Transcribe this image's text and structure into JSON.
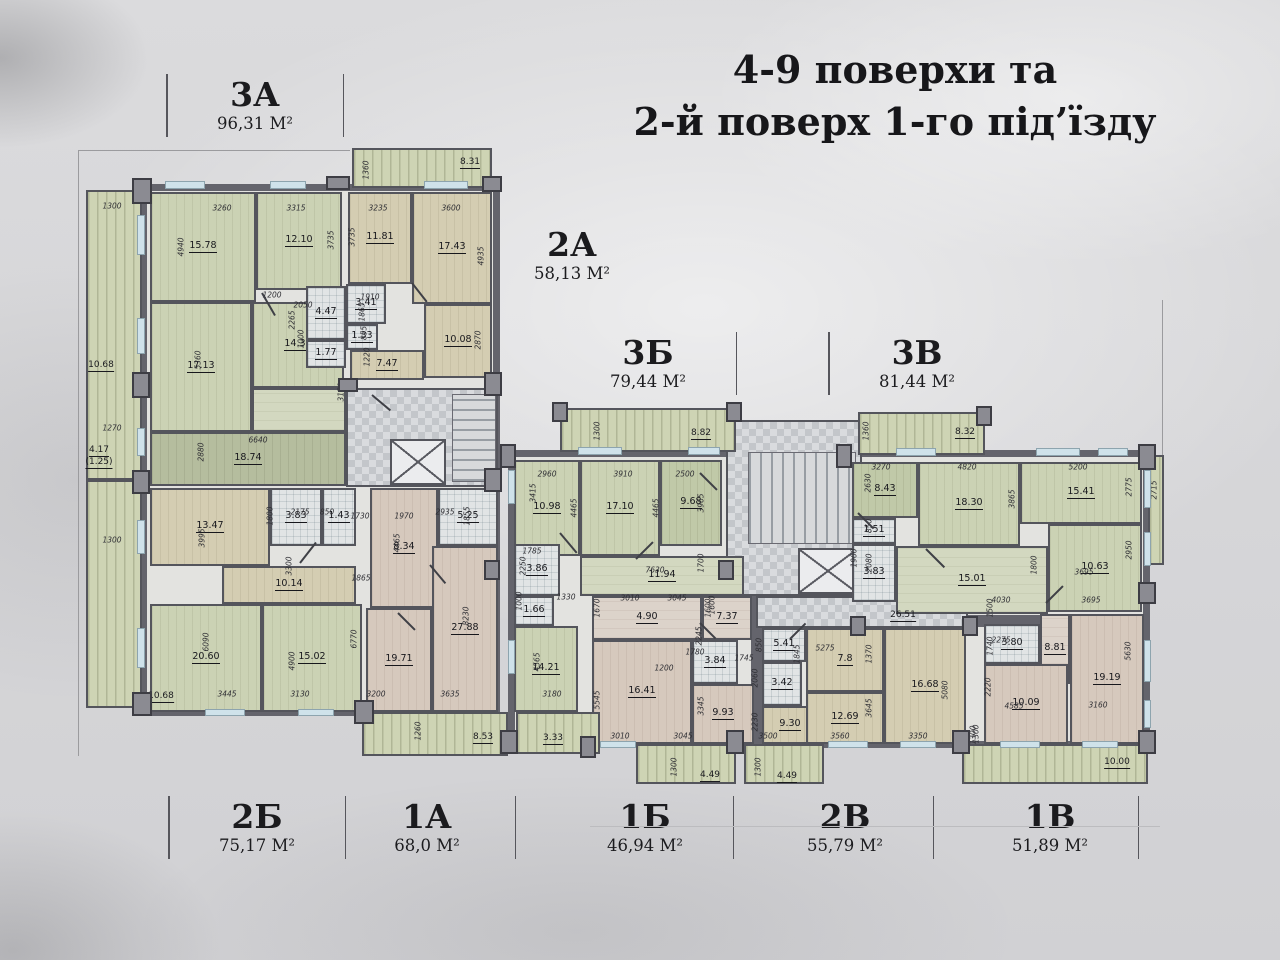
{
  "title": {
    "line1": "4-9 поверхи та",
    "line2": "2-й поверх 1-го під’їзду"
  },
  "apartments": [
    {
      "name": "3А",
      "area": "96,31 М²"
    },
    {
      "name": "2А",
      "area": "58,13 М²"
    },
    {
      "name": "3Б",
      "area": "79,44 М²"
    },
    {
      "name": "3В",
      "area": "81,44 М²"
    },
    {
      "name": "2Б",
      "area": "75,17 М²"
    },
    {
      "name": "1А",
      "area": "68,0 М²"
    },
    {
      "name": "1Б",
      "area": "46,94 М²"
    },
    {
      "name": "2В",
      "area": "55,79 М²"
    },
    {
      "name": "1В",
      "area": "51,89 М²"
    }
  ],
  "rooms": [
    {
      "a": "15.78",
      "x": 150,
      "y": 192,
      "w": 106,
      "h": 110,
      "f": "g"
    },
    {
      "a": "12.10",
      "x": 256,
      "y": 192,
      "w": 86,
      "h": 98,
      "f": "g"
    },
    {
      "a": "17.13",
      "x": 150,
      "y": 302,
      "w": 102,
      "h": 130,
      "f": "g"
    },
    {
      "a": "14.39",
      "x": 252,
      "y": 302,
      "w": 92,
      "h": 86,
      "f": "g"
    },
    {
      "a": "4.47",
      "x": 306,
      "y": 286,
      "w": 40,
      "h": 54,
      "f": "ba"
    },
    {
      "a": "1.77",
      "x": 306,
      "y": 340,
      "w": 40,
      "h": 28,
      "f": "ba"
    },
    {
      "a": "18.74",
      "x": 150,
      "y": 432,
      "w": 196,
      "h": 54,
      "f": "ol"
    },
    {
      "a": "",
      "x": 252,
      "y": 388,
      "w": 94,
      "h": 44,
      "f": "gp"
    },
    {
      "a": "11.81",
      "x": 348,
      "y": 192,
      "w": 64,
      "h": 92,
      "f": "t"
    },
    {
      "a": "17.43",
      "x": 412,
      "y": 192,
      "w": 80,
      "h": 112,
      "f": "t"
    },
    {
      "a": "3.41",
      "x": 346,
      "y": 284,
      "w": 40,
      "h": 40,
      "f": "ba"
    },
    {
      "a": "1.33",
      "x": 346,
      "y": 324,
      "w": 32,
      "h": 26,
      "f": "ba"
    },
    {
      "a": "7.47",
      "x": 350,
      "y": 350,
      "w": 74,
      "h": 30,
      "f": "t"
    },
    {
      "a": "10.08",
      "x": 424,
      "y": 304,
      "w": 68,
      "h": 74,
      "f": "t"
    },
    {
      "a": "13.47",
      "x": 150,
      "y": 488,
      "w": 120,
      "h": 78,
      "f": "t"
    },
    {
      "a": "3.83",
      "x": 270,
      "y": 488,
      "w": 52,
      "h": 58,
      "f": "ba"
    },
    {
      "a": "1.43",
      "x": 322,
      "y": 488,
      "w": 34,
      "h": 58,
      "f": "ba"
    },
    {
      "a": "10.14",
      "x": 222,
      "y": 566,
      "w": 134,
      "h": 38,
      "f": "t"
    },
    {
      "a": "20.60",
      "x": 150,
      "y": 604,
      "w": 112,
      "h": 108,
      "f": "g"
    },
    {
      "a": "15.02",
      "x": 262,
      "y": 604,
      "w": 100,
      "h": 108,
      "f": "g"
    },
    {
      "a": "8.34",
      "x": 370,
      "y": 488,
      "w": 68,
      "h": 120,
      "f": "p"
    },
    {
      "a": "5.25",
      "x": 438,
      "y": 488,
      "w": 60,
      "h": 58,
      "f": "ba"
    },
    {
      "a": "19.71",
      "x": 366,
      "y": 608,
      "w": 66,
      "h": 104,
      "f": "p"
    },
    {
      "a": "27.88",
      "x": 432,
      "y": 546,
      "w": 66,
      "h": 166,
      "f": "p"
    },
    {
      "a": "10.98",
      "x": 514,
      "y": 460,
      "w": 66,
      "h": 96,
      "f": "g"
    },
    {
      "a": "17.10",
      "x": 580,
      "y": 460,
      "w": 80,
      "h": 96,
      "f": "g"
    },
    {
      "a": "9.68",
      "x": 660,
      "y": 460,
      "w": 62,
      "h": 86,
      "f": "g2"
    },
    {
      "a": "11.94",
      "x": 580,
      "y": 556,
      "w": 164,
      "h": 40,
      "f": "gp"
    },
    {
      "a": "3.86",
      "x": 514,
      "y": 544,
      "w": 46,
      "h": 52,
      "f": "ba"
    },
    {
      "a": "1.66",
      "x": 514,
      "y": 596,
      "w": 40,
      "h": 30,
      "f": "ba"
    },
    {
      "a": "14.21",
      "x": 514,
      "y": 626,
      "w": 64,
      "h": 86,
      "f": "g"
    },
    {
      "a": "4.90",
      "x": 592,
      "y": 596,
      "w": 110,
      "h": 44,
      "f": "p2"
    },
    {
      "a": "7.37",
      "x": 702,
      "y": 596,
      "w": 50,
      "h": 44,
      "f": "p2"
    },
    {
      "a": "3.84",
      "x": 692,
      "y": 640,
      "w": 46,
      "h": 44,
      "f": "ba"
    },
    {
      "a": "16.41",
      "x": 592,
      "y": 640,
      "w": 100,
      "h": 104,
      "f": "p"
    },
    {
      "a": "9.93",
      "x": 692,
      "y": 684,
      "w": 62,
      "h": 60,
      "f": "p"
    },
    {
      "a": "5.41",
      "x": 762,
      "y": 628,
      "w": 44,
      "h": 34,
      "f": "ba"
    },
    {
      "a": "3.42",
      "x": 762,
      "y": 662,
      "w": 40,
      "h": 44,
      "f": "ba"
    },
    {
      "a": "9.30",
      "x": 762,
      "y": 706,
      "w": 56,
      "h": 38,
      "f": "t"
    },
    {
      "a": "7.8",
      "x": 806,
      "y": 628,
      "w": 78,
      "h": 64,
      "f": "t"
    },
    {
      "a": "12.69",
      "x": 806,
      "y": 692,
      "w": 78,
      "h": 52,
      "f": "t"
    },
    {
      "a": "16.68",
      "x": 884,
      "y": 628,
      "w": 82,
      "h": 116,
      "f": "t"
    },
    {
      "a": "8.43",
      "x": 852,
      "y": 462,
      "w": 66,
      "h": 56,
      "f": "g2"
    },
    {
      "a": "18.30",
      "x": 918,
      "y": 462,
      "w": 102,
      "h": 84,
      "f": "g"
    },
    {
      "a": "15.41",
      "x": 1020,
      "y": 462,
      "w": 122,
      "h": 62,
      "f": "g"
    },
    {
      "a": "1.51",
      "x": 852,
      "y": 518,
      "w": 44,
      "h": 26,
      "f": "ba"
    },
    {
      "a": "3.83",
      "x": 852,
      "y": 544,
      "w": 44,
      "h": 58,
      "f": "ba"
    },
    {
      "a": "15.01",
      "x": 896,
      "y": 546,
      "w": 152,
      "h": 68,
      "f": "gp"
    },
    {
      "a": "10.63",
      "x": 1048,
      "y": 524,
      "w": 94,
      "h": 88,
      "f": "g"
    },
    {
      "a": "3.80",
      "x": 984,
      "y": 624,
      "w": 56,
      "h": 40,
      "f": "ba"
    },
    {
      "a": "8.81",
      "x": 1040,
      "y": 614,
      "w": 30,
      "h": 70,
      "f": "p2"
    },
    {
      "a": "10.09",
      "x": 984,
      "y": 664,
      "w": 84,
      "h": 80,
      "f": "p"
    },
    {
      "a": "19.19",
      "x": 1070,
      "y": 614,
      "w": 74,
      "h": 130,
      "f": "p"
    },
    {
      "a": "",
      "x": 86,
      "y": 190,
      "w": 56,
      "h": 290,
      "f": "bc"
    },
    {
      "a": "",
      "x": 86,
      "y": 480,
      "w": 56,
      "h": 228,
      "f": "bc"
    },
    {
      "a": "",
      "x": 352,
      "y": 148,
      "w": 140,
      "h": 40,
      "f": "bc"
    },
    {
      "a": "",
      "x": 362,
      "y": 712,
      "w": 146,
      "h": 44,
      "f": "bc"
    },
    {
      "a": "",
      "x": 560,
      "y": 408,
      "w": 176,
      "h": 44,
      "f": "bc"
    },
    {
      "a": "",
      "x": 516,
      "y": 712,
      "w": 84,
      "h": 42,
      "f": "bc"
    },
    {
      "a": "",
      "x": 636,
      "y": 744,
      "w": 100,
      "h": 40,
      "f": "bc"
    },
    {
      "a": "",
      "x": 744,
      "y": 744,
      "w": 80,
      "h": 40,
      "f": "bc"
    },
    {
      "a": "",
      "x": 858,
      "y": 412,
      "w": 127,
      "h": 43,
      "f": "bc"
    },
    {
      "a": "",
      "x": 962,
      "y": 744,
      "w": 186,
      "h": 40,
      "f": "bc"
    },
    {
      "a": "",
      "x": 1148,
      "y": 455,
      "w": 16,
      "h": 110,
      "f": "bc"
    }
  ],
  "dims": [
    [
      "1300",
      112,
      206,
      0
    ],
    [
      "4940",
      181,
      247,
      -90
    ],
    [
      "10.68",
      101,
      366,
      0,
      "u"
    ],
    [
      "1270",
      112,
      428,
      0
    ],
    [
      "4.17",
      99,
      451,
      0,
      "u"
    ],
    [
      "(1.25)",
      99,
      463,
      0,
      "u"
    ],
    [
      "1300",
      112,
      540,
      0
    ],
    [
      "10.68",
      161,
      697,
      0,
      "u"
    ],
    [
      "3260",
      222,
      208,
      0
    ],
    [
      "3315",
      296,
      208,
      0
    ],
    [
      "3735",
      331,
      240,
      -90
    ],
    [
      "4935",
      481,
      256,
      -90
    ],
    [
      "3235",
      378,
      208,
      0
    ],
    [
      "3600",
      451,
      208,
      0
    ],
    [
      "3735",
      352,
      237,
      -90
    ],
    [
      "1360",
      366,
      170,
      -90
    ],
    [
      "8.31",
      470,
      163,
      0,
      "u"
    ],
    [
      "1200",
      272,
      295,
      0
    ],
    [
      "2050",
      303,
      305,
      0
    ],
    [
      "2265",
      292,
      320,
      -90
    ],
    [
      "1000",
      301,
      339,
      -90
    ],
    [
      "5360",
      198,
      360,
      -90
    ],
    [
      "3150",
      341,
      392,
      -90
    ],
    [
      "6640",
      258,
      440,
      0
    ],
    [
      "2880",
      201,
      452,
      -90
    ],
    [
      "1910",
      370,
      297,
      0
    ],
    [
      "1865",
      362,
      312,
      -90
    ],
    [
      "855",
      364,
      333,
      -90
    ],
    [
      "1220",
      367,
      357,
      -90
    ],
    [
      "2870",
      478,
      340,
      -90
    ],
    [
      "2175",
      300,
      512,
      0
    ],
    [
      "850",
      327,
      512,
      0
    ],
    [
      "1800",
      270,
      516,
      -90
    ],
    [
      "3995",
      202,
      538,
      -90
    ],
    [
      "3300",
      289,
      566,
      -90
    ],
    [
      "1730",
      360,
      516,
      0
    ],
    [
      "1970",
      404,
      516,
      0
    ],
    [
      "2935",
      445,
      512,
      0
    ],
    [
      "1855",
      467,
      516,
      -90
    ],
    [
      "4465",
      397,
      543,
      -90
    ],
    [
      "1865",
      361,
      578,
      0
    ],
    [
      "6090",
      206,
      642,
      -90
    ],
    [
      "3445",
      227,
      694,
      0
    ],
    [
      "4900",
      292,
      661,
      -90
    ],
    [
      "3130",
      300,
      694,
      0
    ],
    [
      "6770",
      354,
      639,
      -90
    ],
    [
      "8230",
      466,
      616,
      -90
    ],
    [
      "3200",
      376,
      694,
      0
    ],
    [
      "3635",
      450,
      694,
      0
    ],
    [
      "1260",
      418,
      731,
      -90
    ],
    [
      "8.53",
      483,
      738,
      0,
      "u"
    ],
    [
      "1300",
      597,
      431,
      -90
    ],
    [
      "8.82",
      701,
      434,
      0,
      "u"
    ],
    [
      "2960",
      547,
      474,
      0
    ],
    [
      "3910",
      623,
      474,
      0
    ],
    [
      "2500",
      685,
      474,
      0
    ],
    [
      "3415",
      533,
      493,
      -90
    ],
    [
      "4465",
      574,
      508,
      -90
    ],
    [
      "4465",
      656,
      508,
      -90
    ],
    [
      "3965",
      701,
      503,
      -90
    ],
    [
      "1785",
      532,
      551,
      0
    ],
    [
      "2250",
      523,
      566,
      -90
    ],
    [
      "1330",
      566,
      597,
      0
    ],
    [
      "1000",
      519,
      601,
      -90
    ],
    [
      "7630",
      655,
      570,
      0
    ],
    [
      "1700",
      701,
      563,
      -90
    ],
    [
      "4565",
      537,
      662,
      -90
    ],
    [
      "3180",
      552,
      694,
      0
    ],
    [
      "3.33",
      553,
      739,
      0,
      "u"
    ],
    [
      "1670",
      597,
      608,
      -90
    ],
    [
      "3010",
      630,
      598,
      0
    ],
    [
      "3045",
      677,
      598,
      0
    ],
    [
      "1600",
      708,
      608,
      -90
    ],
    [
      "2245",
      699,
      636,
      -90
    ],
    [
      "1780",
      695,
      652,
      0
    ],
    [
      "1200",
      664,
      668,
      0
    ],
    [
      "5545",
      597,
      700,
      -90
    ],
    [
      "3345",
      701,
      706,
      -90
    ],
    [
      "3010",
      620,
      736,
      0
    ],
    [
      "3045",
      683,
      736,
      0
    ],
    [
      "1300",
      674,
      767,
      -90
    ],
    [
      "4.49",
      710,
      776,
      0,
      "u"
    ],
    [
      "1300",
      758,
      767,
      -90
    ],
    [
      "4.49",
      787,
      777,
      0,
      "u"
    ],
    [
      "26.51",
      903,
      616,
      0,
      "u"
    ],
    [
      "1600",
      712,
      605,
      -90
    ],
    [
      "850",
      759,
      645,
      -90
    ],
    [
      "1845",
      797,
      654,
      -90
    ],
    [
      "5275",
      825,
      648,
      0
    ],
    [
      "1370",
      869,
      654,
      -90
    ],
    [
      "1745",
      744,
      658,
      0
    ],
    [
      "2060",
      755,
      678,
      -90
    ],
    [
      "2230",
      755,
      722,
      -90
    ],
    [
      "3500",
      768,
      736,
      0
    ],
    [
      "3560",
      840,
      736,
      0
    ],
    [
      "3645",
      869,
      708,
      -90
    ],
    [
      "5080",
      945,
      690,
      -90
    ],
    [
      "3350",
      918,
      736,
      0
    ],
    [
      "1300",
      976,
      734,
      -90
    ],
    [
      "1360",
      866,
      431,
      -90
    ],
    [
      "8.32",
      965,
      433,
      0,
      "u"
    ],
    [
      "3270",
      881,
      467,
      0
    ],
    [
      "4820",
      967,
      467,
      0
    ],
    [
      "5200",
      1078,
      467,
      0
    ],
    [
      "2630",
      868,
      483,
      -90
    ],
    [
      "3865",
      1012,
      499,
      -90
    ],
    [
      "2775",
      1129,
      487,
      -90
    ],
    [
      "850",
      869,
      526,
      -90
    ],
    [
      "1900",
      854,
      558,
      -90
    ],
    [
      "2080",
      869,
      563,
      -90
    ],
    [
      "1800",
      1034,
      565,
      -90
    ],
    [
      "2950",
      1129,
      550,
      -90
    ],
    [
      "3695",
      1084,
      572,
      0
    ],
    [
      "2715",
      1154,
      490,
      -90
    ],
    [
      "4030",
      1001,
      600,
      0
    ],
    [
      "1500",
      990,
      608,
      -90
    ],
    [
      "3695",
      1091,
      600,
      0
    ],
    [
      "2275",
      1001,
      640,
      0
    ],
    [
      "1740",
      990,
      646,
      -90
    ],
    [
      "2220",
      988,
      687,
      -90
    ],
    [
      "4585",
      1014,
      706,
      0
    ],
    [
      "3160",
      1098,
      705,
      0
    ],
    [
      "5630",
      1128,
      651,
      -90
    ],
    [
      "1300",
      973,
      735,
      -90
    ],
    [
      "10.00",
      1117,
      763,
      0,
      "u"
    ]
  ]
}
